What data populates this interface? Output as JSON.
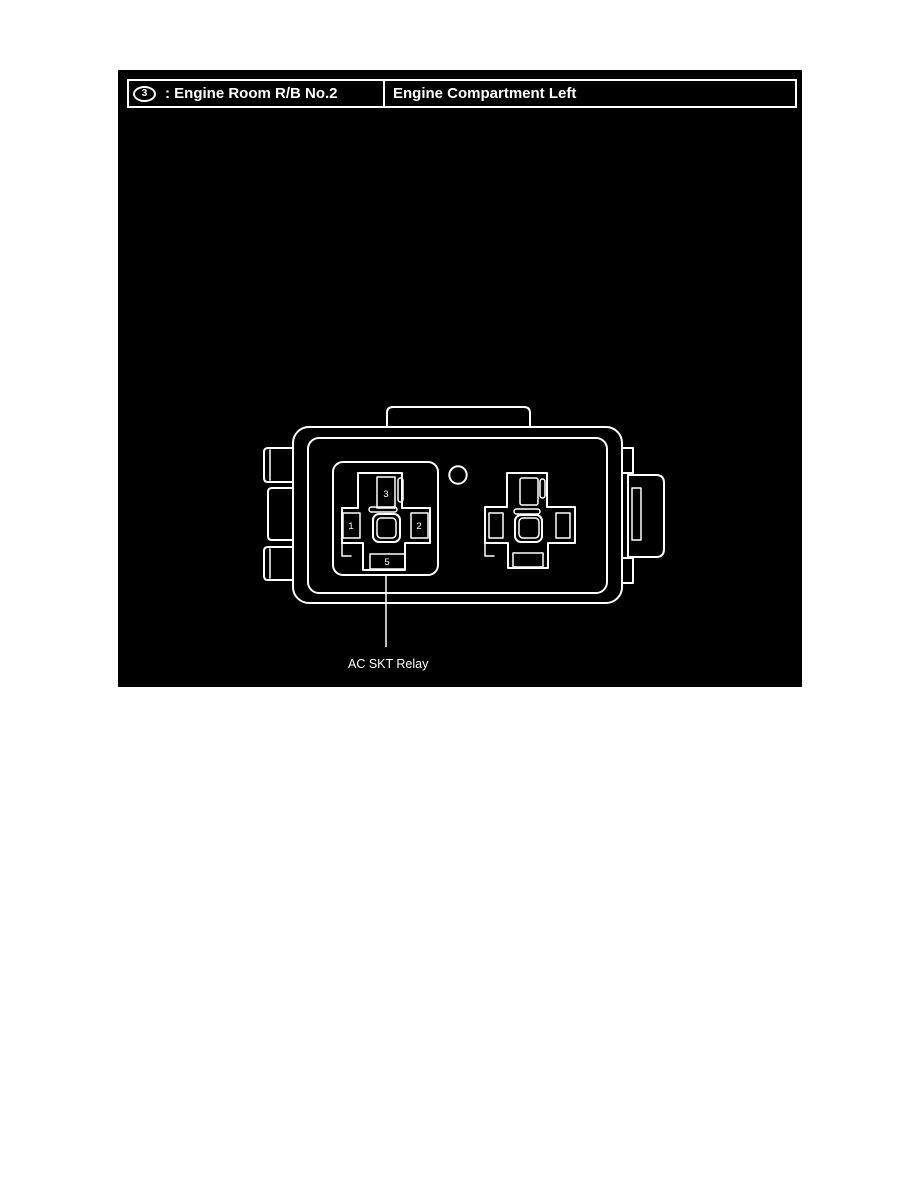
{
  "colors": {
    "page_background": "#ffffff",
    "panel_background": "#000000",
    "line_color": "#ffffff",
    "text_color": "#ffffff"
  },
  "header": {
    "callout_number": "3",
    "title_left": ": Engine Room R/B No.2",
    "title_right": "Engine Compartment Left"
  },
  "diagram": {
    "relay_label": "AC SKT Relay",
    "terminals": {
      "pin1": "1",
      "pin2": "2",
      "pin3": "3",
      "pin5": "5"
    }
  }
}
